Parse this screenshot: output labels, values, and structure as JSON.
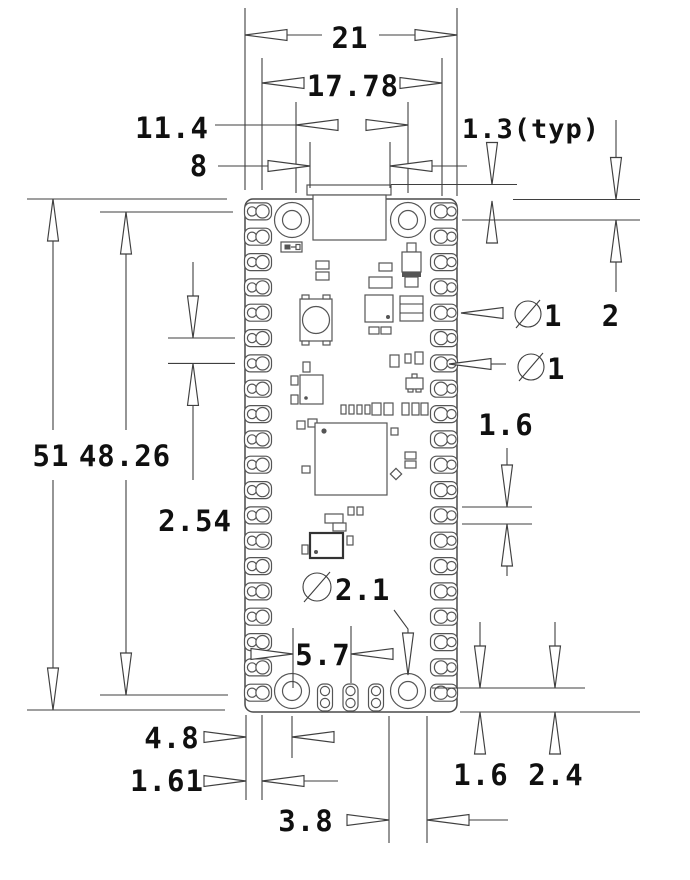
{
  "drawing": {
    "kind": "pcb-mechanical-dimension-drawing",
    "units_implied": "mm",
    "line_color": "#3f3f3f",
    "text_color": "#101010",
    "dims": {
      "board_width": "21",
      "pin_column_span": "17.78",
      "mount_hole_span_x": "11.4",
      "usb_width": "8",
      "usb_overhang": "1.3(typ)",
      "hole_offset_top": "2",
      "pin_hole_diameter": "1",
      "castellation_diameter": "1",
      "pad_length_right": "1.6",
      "board_length": "51",
      "pin_row_span": "48.26",
      "pin_pitch": "2.54",
      "mount_hole_diameter": "2.1",
      "swd_pad_offset": "5.7",
      "hole_offset_left": "4.8",
      "pad_edge_offset": "1.61",
      "hole_pad_diameter": "3.8",
      "pad_length_bottom": "1.6",
      "hole_offset_bottom": "2.4"
    }
  }
}
